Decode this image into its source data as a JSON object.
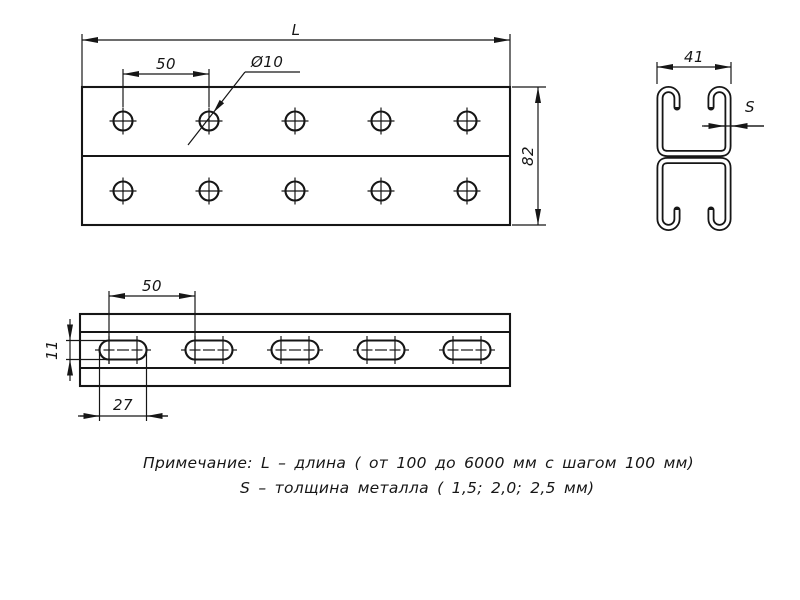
{
  "drawing": {
    "top_view": {
      "length_label": "L",
      "hole_spacing": "50",
      "hole_diameter": "Ø10",
      "plate_height": "82"
    },
    "section_view": {
      "profile_width": "41",
      "thickness_label": "S"
    },
    "front_view": {
      "slot_spacing": "50",
      "slot_height": "11",
      "slot_length": "27"
    },
    "note": {
      "line1": "Примечание: L – длина ( от 100 до 6000 мм с шагом 100 мм)",
      "line2": "S – толщина металла ( 1,5; 2,0; 2,5 мм)"
    },
    "colors": {
      "line": "#161616",
      "background": "#ffffff"
    }
  }
}
